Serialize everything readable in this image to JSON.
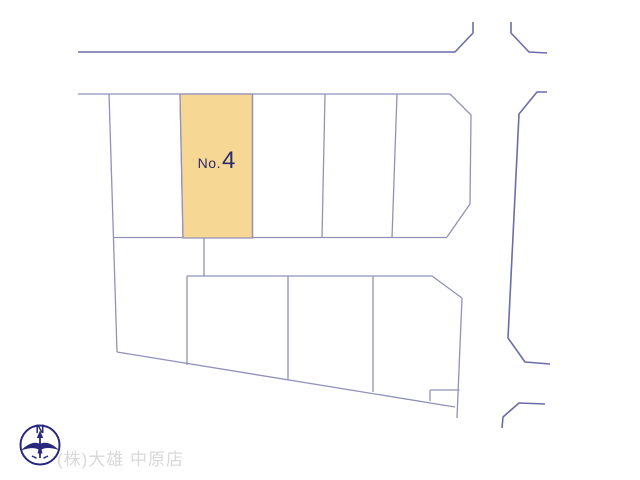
{
  "map": {
    "highlighted_plot": {
      "prefix": "No.",
      "number": "4"
    },
    "colors": {
      "highlight_fill": "#F7D794",
      "parcel_line": "#9191BA",
      "road_line": "#6C6CA9",
      "plot_label_text": "#2B2B6E"
    }
  },
  "compass": {
    "north_label": "N",
    "color": "#28287E"
  },
  "footer": {
    "company_name": "(株)大雄 中原店",
    "text_color": "#D8D8D8"
  }
}
